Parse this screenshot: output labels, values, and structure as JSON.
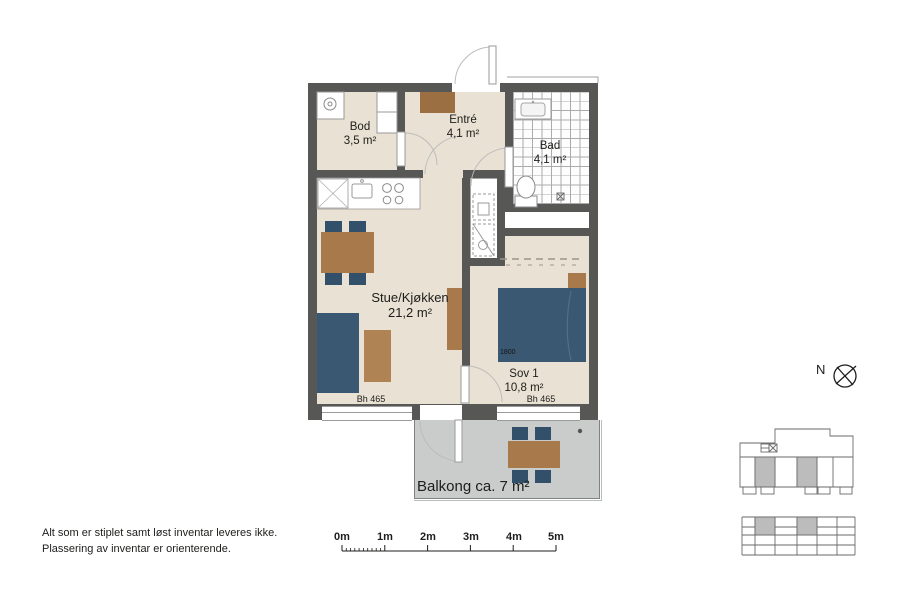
{
  "rooms": {
    "bod": {
      "name": "Bod",
      "area": "3,5 m²"
    },
    "entre": {
      "name": "Entré",
      "area": "4,1 m²"
    },
    "bad": {
      "name": "Bad",
      "area": "4,1 m²"
    },
    "stue": {
      "name": "Stue/Kjøkken",
      "area": "21,2 m²"
    },
    "sov1": {
      "name": "Sov 1",
      "area": "10,8 m²"
    },
    "balkong": {
      "label": "Balkong ca. 7 m²"
    }
  },
  "annotations": {
    "bed_width": "1800",
    "window_sill_left": "Bh 465",
    "window_sill_right": "Bh 465"
  },
  "compass": {
    "north": "N"
  },
  "scale_bar": {
    "labels": [
      "0m",
      "1m",
      "2m",
      "3m",
      "4m",
      "5m"
    ]
  },
  "notes": {
    "line1": "Alt som er stiplet samt løst inventar leveres ikke.",
    "line2": "Plassering av inventar er orienterende."
  },
  "colors": {
    "wall": "#575756",
    "floor": "#e9e1d3",
    "wet_room": "#ffffff",
    "wood_furniture": "#a87a4b",
    "dark_furniture": "#3b5872",
    "chair": "#33506a",
    "balcony_floor": "#c9cccb",
    "text": "#1d1d1b"
  }
}
